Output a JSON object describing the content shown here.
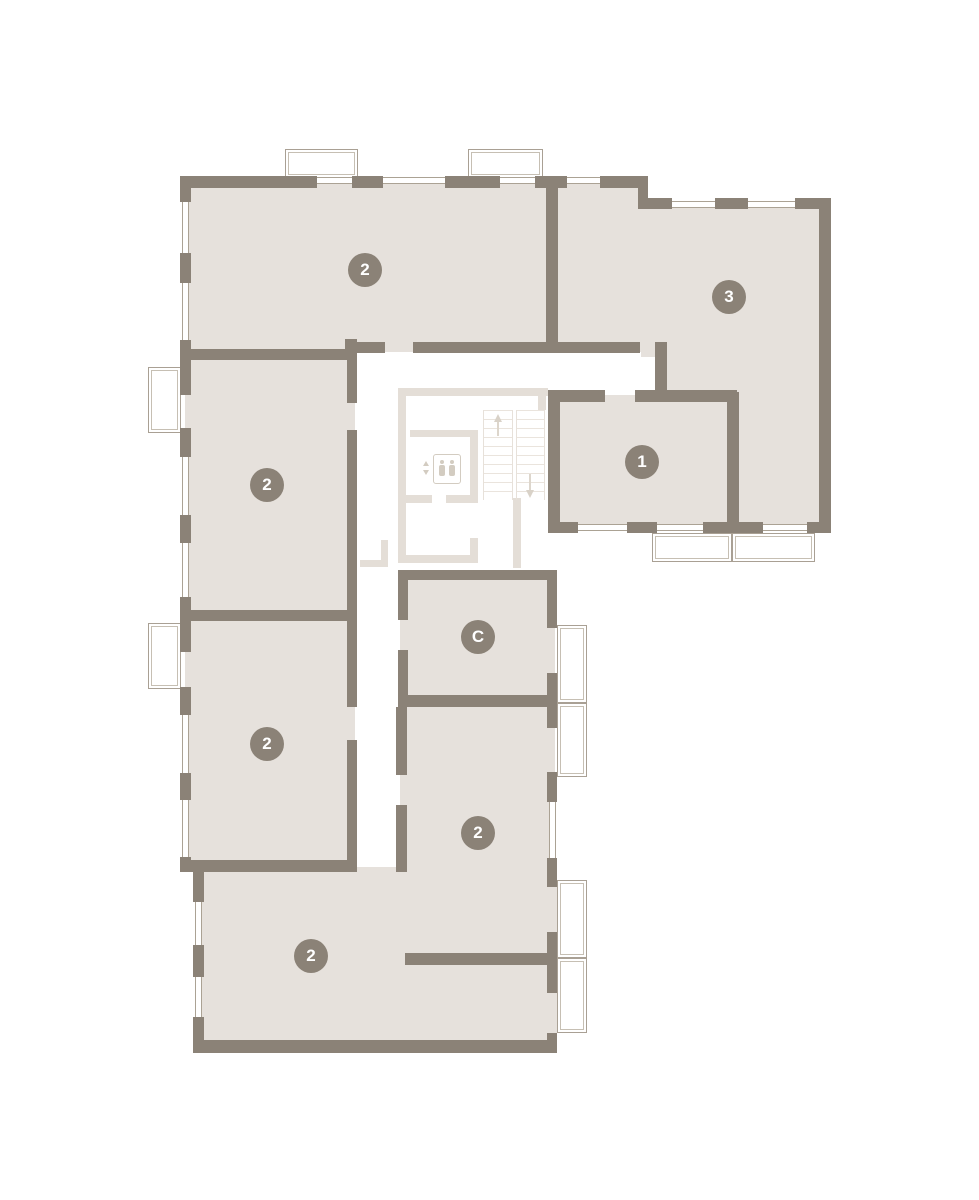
{
  "plan": {
    "name": "residential-floor-plan",
    "units": [
      {
        "id": "unit-top-left",
        "label": "2"
      },
      {
        "id": "unit-top-right",
        "label": "3"
      },
      {
        "id": "unit-center-right",
        "label": "1"
      },
      {
        "id": "unit-mid-left",
        "label": "2"
      },
      {
        "id": "unit-studio",
        "label": "C"
      },
      {
        "id": "unit-lower-left",
        "label": "2"
      },
      {
        "id": "unit-bottom-center",
        "label": "2"
      },
      {
        "id": "unit-bottom",
        "label": "2"
      }
    ],
    "colors": {
      "wall": "#8b8277",
      "room_fill": "#e6e1dc",
      "core_light": "#e4ded7",
      "badge": "#8b8277",
      "badge_text": "#ffffff",
      "balcony_outline": "#a9a094"
    }
  }
}
